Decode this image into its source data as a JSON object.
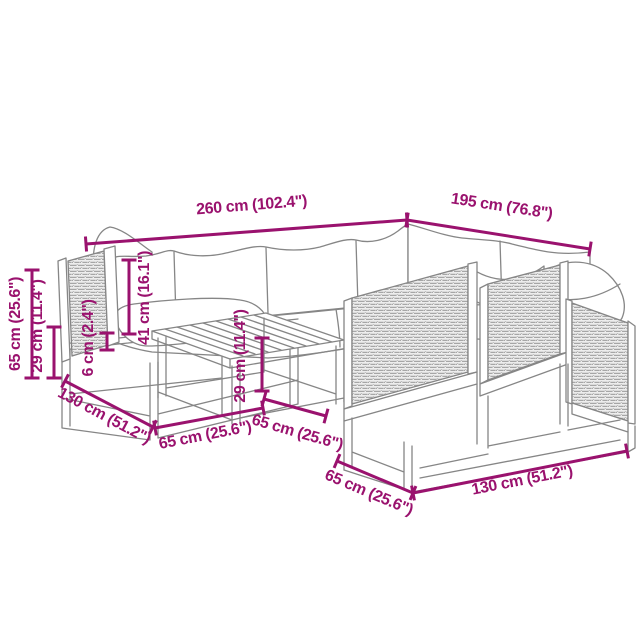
{
  "canvas": {
    "width": 640,
    "height": 640,
    "background": "#ffffff"
  },
  "style": {
    "dimension_color": "#9A126E",
    "outline_color": "#868686",
    "rattan_fill": "#ededed",
    "rattan_weave_color": "#a6a6a6",
    "cushion_fill": "#ffffff",
    "dimension_stroke_width": 3,
    "dimension_tick_half_length": 7.5
  },
  "illustration": {
    "type": "line-drawing",
    "subject": "garden-lounge-set-with-rattan-panels",
    "parts": [
      "corner-back-cushion",
      "back-cushions",
      "seat-cushions",
      "left-arm-rattan-panel",
      "ottoman-cushion",
      "base-frame-left",
      "coffee-table",
      "right-module-rattan-panels",
      "right-module-cushion",
      "scatter-pillow",
      "base-frame-right"
    ]
  },
  "dimensions": [
    {
      "name": "total-width",
      "label": "260 cm (102.4\")",
      "line": {
        "x1": 86,
        "y1": 244,
        "x2": 407,
        "y2": 220
      },
      "text": {
        "x": 252,
        "y": 210,
        "rotate": -4.5
      }
    },
    {
      "name": "total-depth",
      "label": "195 cm (76.8\")",
      "line": {
        "x1": 407,
        "y1": 220,
        "x2": 590,
        "y2": 249
      },
      "text": {
        "x": 501,
        "y": 211,
        "rotate": 8.7
      }
    },
    {
      "name": "total-height",
      "label": "65 cm (25.6\")",
      "line": {
        "x1": 32,
        "y1": 270,
        "x2": 32,
        "y2": 378
      },
      "text": {
        "x": 20,
        "y": 324,
        "rotate": -90
      }
    },
    {
      "name": "seat-frame-height",
      "label": "29 cm (11.4\")",
      "line": {
        "x1": 54,
        "y1": 327,
        "x2": 54,
        "y2": 378
      },
      "text": {
        "x": 42,
        "y": 326,
        "rotate": -90
      }
    },
    {
      "name": "back-cushion-height",
      "label": "41 cm (16.1\")",
      "line": {
        "x1": 129,
        "y1": 260,
        "x2": 129,
        "y2": 334
      },
      "text": {
        "x": 149,
        "y": 298,
        "rotate": -90
      }
    },
    {
      "name": "seat-cushion-thickness",
      "label": "6 cm (2.4\")",
      "line": {
        "x1": 107,
        "y1": 333,
        "x2": 107,
        "y2": 350
      },
      "text": {
        "x": 93,
        "y": 338,
        "rotate": -90
      }
    },
    {
      "name": "module-depth-left",
      "label": "130 cm (51.2\")",
      "line": {
        "x1": 65,
        "y1": 381,
        "x2": 153,
        "y2": 427
      },
      "text": {
        "x": 102,
        "y": 420,
        "rotate": 28
      }
    },
    {
      "name": "module-width-front",
      "label": "65 cm (25.6\")",
      "line": {
        "x1": 155,
        "y1": 428,
        "x2": 263,
        "y2": 408
      },
      "text": {
        "x": 206,
        "y": 440,
        "rotate": -11
      }
    },
    {
      "name": "table-height",
      "label": "29 cm (11.4\")",
      "line": {
        "x1": 262,
        "y1": 338,
        "x2": 262,
        "y2": 391
      },
      "text": {
        "x": 245,
        "y": 356,
        "rotate": -90
      }
    },
    {
      "name": "table-depth",
      "label": "65 cm (25.6\")",
      "line": {
        "x1": 264,
        "y1": 399,
        "x2": 326,
        "y2": 416
      },
      "text": {
        "x": 296,
        "y": 437,
        "rotate": 16
      }
    },
    {
      "name": "module-depth-right",
      "label": "65 cm (25.6\")",
      "line": {
        "x1": 337,
        "y1": 461,
        "x2": 413,
        "y2": 493
      },
      "text": {
        "x": 367,
        "y": 497,
        "rotate": 23
      }
    },
    {
      "name": "module-width-right",
      "label": "130 cm (51.2\")",
      "line": {
        "x1": 413,
        "y1": 493,
        "x2": 627,
        "y2": 451
      },
      "text": {
        "x": 523,
        "y": 485,
        "rotate": -11
      }
    }
  ]
}
